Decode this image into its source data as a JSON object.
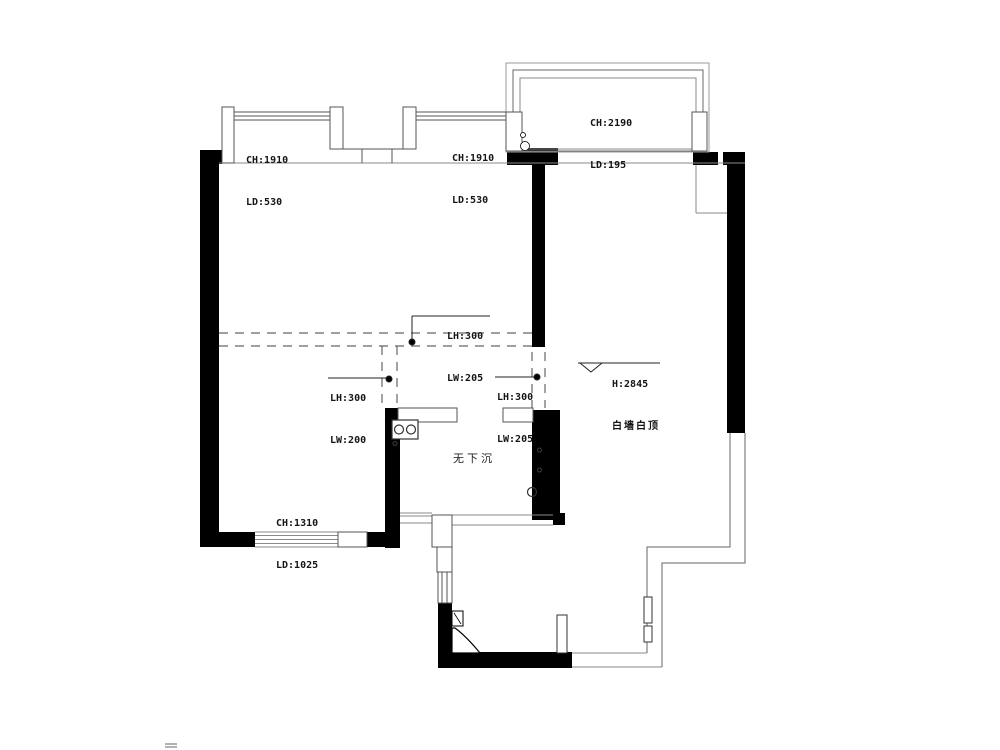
{
  "colors": {
    "wall": "#000000",
    "thin_line": "#7f7f7f",
    "dashed_line": "#666666",
    "text": "#141414",
    "background": "#ffffff"
  },
  "annotations": {
    "window_left": {
      "line1": "CH:1910",
      "line2": "LD:530"
    },
    "window_right": {
      "line1": "CH:1910",
      "line2": "LD:530"
    },
    "balcony": {
      "line1": "CH:2190",
      "line2": "LD:195"
    },
    "beam_top": {
      "line1": "LH:300",
      "line2": "LW:205"
    },
    "beam_left": {
      "line1": "LH:300",
      "line2": "LW:200"
    },
    "beam_right": {
      "line1": "LH:300",
      "line2": "LW:205"
    },
    "ceiling_height": {
      "line1": "H:2845",
      "line2": "白墙白顶"
    },
    "no_sunken": {
      "text": "无下沉"
    },
    "window_bottom": {
      "line1": "CH:1310",
      "line2": "LD:1025"
    }
  }
}
